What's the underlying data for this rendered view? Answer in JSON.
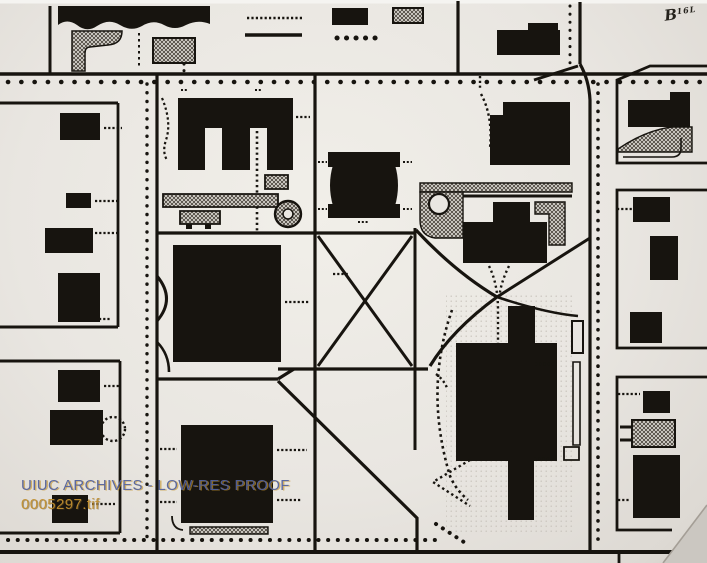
{
  "photo": {
    "description": "Archival black-and-white photograph of a campus block map",
    "colors": {
      "ink": "#17140f",
      "paper": "#e9e6e1",
      "paper_edge": "#f5f4f1",
      "hatch_line": "#4a443c",
      "fold": "#cbc7c1",
      "fold_edge": "#a49e96",
      "watermark_blue": "#55639b",
      "watermark_gold": "#c08e2e"
    }
  },
  "watermark": {
    "line1": "UIUC ARCHIVES - LOW-RES PROOF",
    "line2": "0005297.tif"
  },
  "annotation": {
    "prefix": "B",
    "suffix": "16L"
  },
  "map": {
    "shapes": [
      {
        "n": "photo-top-edge",
        "k": "f",
        "d": "M0,0H707V3.5H0Z",
        "f": "#f5f4f1"
      },
      {
        "n": "plaza-stipple",
        "k": "hl",
        "d": "M446,292h126v240h-126z"
      },
      {
        "n": "bldg-banner-nw",
        "k": "f",
        "d": "M58,6H210V24Q198,19 186,25Q175,31 164,25Q153,19 142,26Q131,32 120,25Q109,18 97,26Q87,33 77,25Q67,18 58,25Z"
      },
      {
        "n": "road-v-nw",
        "k": "s",
        "d": "M50,6V73",
        "w": 3
      },
      {
        "n": "hatch-lot-nw",
        "k": "h",
        "d": "M72,31H122Q122,44 108,45L90,47Q85,47 85,53V71H72Z",
        "w": 1.5
      },
      {
        "n": "dash-path-nw",
        "k": "s",
        "d": "M139,33V69",
        "w": 2,
        "da": "2.5 3.5"
      },
      {
        "n": "hatch-lot-nw2",
        "k": "h",
        "d": "M153,38h42v25h-42z",
        "w": 2
      },
      {
        "n": "dots-nw2",
        "k": "s",
        "d": "M184,64V76",
        "w": 3,
        "da": "0.1 6.5",
        "cap": "round"
      },
      {
        "n": "tick-row-top",
        "k": "s",
        "d": "M247,18H302",
        "w": 2.6,
        "da": "2.2 2.2"
      },
      {
        "n": "bar-line-top",
        "k": "s",
        "d": "M245,35H302",
        "w": 3.6
      },
      {
        "n": "bldg-top-1",
        "k": "f",
        "d": "M332,8h36v17h-36z"
      },
      {
        "n": "hatch-top-1",
        "k": "h",
        "d": "M393,8h30v15h-30z",
        "w": 2
      },
      {
        "n": "dot-row-top",
        "k": "s",
        "d": "M337,38H384",
        "w": 5,
        "da": "0.1 9.4",
        "cap": "round"
      },
      {
        "n": "bldg-top-2",
        "k": "f",
        "d": "M497,30h63v25h-63z"
      },
      {
        "n": "bldg-top-2b",
        "k": "f",
        "d": "M528,23h30v8h-30z"
      },
      {
        "n": "dots-v-ne",
        "k": "s",
        "d": "M570,6V66",
        "w": 3,
        "da": "0.1 8",
        "cap": "round"
      },
      {
        "n": "road-v-ne",
        "k": "s",
        "d": "M580,2V64",
        "w": 3.2
      },
      {
        "n": "road-ramp-ne",
        "k": "s",
        "d": "M578,66L534,80",
        "w": 3
      },
      {
        "n": "road-h-north",
        "k": "s",
        "d": "M0,74H707",
        "w": 3.6
      },
      {
        "n": "tree-dots-north",
        "k": "s",
        "d": "M8,82H700",
        "w": 4.6,
        "da": "0.1 13.2",
        "cap": "round"
      },
      {
        "n": "road-v-4",
        "k": "s",
        "d": "M458,1V74",
        "w": 3.2
      },
      {
        "n": "road-v-main-west",
        "k": "s",
        "d": "M157,74V552",
        "w": 3.2
      },
      {
        "n": "road-v-center",
        "k": "s",
        "d": "M315,74V552",
        "w": 3.2
      },
      {
        "n": "road-v-east",
        "k": "s",
        "d": "M580,64Q589,80 590,100V552",
        "w": 3.2
      },
      {
        "n": "tree-dots-v-west",
        "k": "s",
        "d": "M147,84V543",
        "w": 3.4,
        "da": "0.1 8.6",
        "cap": "round"
      },
      {
        "n": "tree-dots-v-east",
        "k": "s",
        "d": "M598,84V548",
        "w": 3.6,
        "da": "0.1 9",
        "cap": "round"
      },
      {
        "n": "road-h-south",
        "k": "s",
        "d": "M0,552H707",
        "w": 4
      },
      {
        "n": "tree-dots-south",
        "k": "s",
        "d": "M8,540H437",
        "w": 4,
        "da": "0.1 9.6",
        "cap": "round"
      },
      {
        "n": "road-h-w1",
        "k": "s",
        "d": "M0,103H118",
        "w": 3
      },
      {
        "n": "block-edge-w1",
        "k": "s",
        "d": "M118,103V327",
        "w": 2.8
      },
      {
        "n": "road-h-w2",
        "k": "s",
        "d": "M0,327H118",
        "w": 3
      },
      {
        "n": "road-h-w3",
        "k": "s",
        "d": "M0,361H120",
        "w": 3
      },
      {
        "n": "block-edge-w2",
        "k": "s",
        "d": "M120,361V533",
        "w": 2.8
      },
      {
        "n": "road-h-w4",
        "k": "s",
        "d": "M0,533H120",
        "w": 3
      },
      {
        "n": "bldg-w1",
        "k": "f",
        "d": "M60,113h40v27h-40z"
      },
      {
        "n": "bldg-w2",
        "k": "f",
        "d": "M66,193h25v15h-25z"
      },
      {
        "n": "bldg-w3",
        "k": "f",
        "d": "M45,228h48v25h-48z"
      },
      {
        "n": "bldg-w4",
        "k": "f",
        "d": "M58,273h42v49h-42z"
      },
      {
        "n": "dash-w1",
        "k": "s",
        "d": "M104,128H122",
        "w": 2.2,
        "da": "2.2 2"
      },
      {
        "n": "dash-w2",
        "k": "s",
        "d": "M95,201H118",
        "w": 2.2,
        "da": "2.2 2"
      },
      {
        "n": "dash-w3",
        "k": "s",
        "d": "M95,233H117",
        "w": 2.2,
        "da": "2.2 2"
      },
      {
        "n": "dash-w4",
        "k": "s",
        "d": "M99,319H110",
        "w": 2.2,
        "da": "2.2 2"
      },
      {
        "n": "bldg-w5",
        "k": "f",
        "d": "M58,370h42v32h-42z"
      },
      {
        "n": "bldg-w6",
        "k": "f",
        "d": "M50,410h53v35h-53z"
      },
      {
        "n": "bldg-w7",
        "k": "f",
        "d": "M52,495h36v28h-36z"
      },
      {
        "n": "dash-w5",
        "k": "s",
        "d": "M104,386H120",
        "w": 2.2,
        "da": "2.2 2"
      },
      {
        "n": "dash-w6",
        "k": "s",
        "d": "M92,504H115",
        "w": 2.2,
        "da": "2.2 2"
      },
      {
        "n": "dashed-circle-w",
        "k": "c",
        "cx": 113,
        "cy": 429,
        "r": 12,
        "w": 2.4,
        "da": "2.3 2.5"
      },
      {
        "n": "bldg-comb-e",
        "k": "f",
        "d": "M178,98H293V170H267V128H250V170H222V128H205V170H178Z"
      },
      {
        "n": "dash-e-top1",
        "k": "s",
        "d": "M181,90H187",
        "w": 2,
        "da": "2 1.8"
      },
      {
        "n": "dash-e-top2",
        "k": "s",
        "d": "M255,90H261",
        "w": 2,
        "da": "2 1.8"
      },
      {
        "n": "dash-e-left-curve",
        "k": "s",
        "d": "M162,98Q172,122 166,140Q162,152 167,160",
        "w": 2.2,
        "da": "2.4 2.6"
      },
      {
        "n": "dash-e-right",
        "k": "s",
        "d": "M296,117H310",
        "w": 2.2,
        "da": "2.2 2"
      },
      {
        "n": "dotted-path-e",
        "k": "s",
        "d": "M257,131V231",
        "w": 2.6,
        "da": "2.2 3.2"
      },
      {
        "n": "loop-band-hatch",
        "k": "h",
        "d": "M163,194h115v13h-115z",
        "w": 1.8
      },
      {
        "n": "loop-circle",
        "k": "c",
        "cx": 288,
        "cy": 214,
        "r": 13,
        "f": "url(#hp)",
        "w": 2.4
      },
      {
        "n": "loop-circle-center",
        "k": "c",
        "cx": 288,
        "cy": 214,
        "r": 5,
        "f": "#e9e6e1",
        "w": 1.6
      },
      {
        "n": "hatch-pad-e",
        "k": "h",
        "d": "M180,211h40v13h-40z",
        "w": 1.8
      },
      {
        "n": "pad-leg1",
        "k": "f",
        "d": "M186,224h6v5h-6z"
      },
      {
        "n": "pad-leg2",
        "k": "f",
        "d": "M205,224h6v5h-6z"
      },
      {
        "n": "hatch-pad-e2",
        "k": "h",
        "d": "M265,175h23v14h-23z",
        "w": 1.8
      },
      {
        "n": "road-h-quad-n",
        "k": "s",
        "d": "M157,233H416",
        "w": 3.2
      },
      {
        "n": "bldg-big-nw",
        "k": "f",
        "d": "M173,245h108v117h-108z"
      },
      {
        "n": "drive-arc",
        "k": "s",
        "d": "M157,276Q176,299 157,321",
        "w": 3
      },
      {
        "n": "dash-c1",
        "k": "s",
        "d": "M285,302H310",
        "w": 2.2,
        "da": "2.2 2"
      },
      {
        "n": "road-h-mid-w",
        "k": "s",
        "d": "M157,379H278",
        "w": 3.2
      },
      {
        "n": "drive-arc2",
        "k": "s",
        "d": "M157,342Q169,354 169,372",
        "w": 2.6
      },
      {
        "n": "road-y-join",
        "k": "s",
        "d": "M278,379L294,369",
        "w": 3.2
      },
      {
        "n": "road-h-mid",
        "k": "s",
        "d": "M278,369H428",
        "w": 3.2
      },
      {
        "n": "bldg-barrel-top",
        "k": "f",
        "d": "M328,152h72v15h-72z"
      },
      {
        "n": "bldg-barrel-bot",
        "k": "f",
        "d": "M328,204h72v14h-72z"
      },
      {
        "n": "bldg-barrel-mid",
        "k": "f",
        "d": "M333,165Q327,185 333,206L395,206Q401,185 395,165Z"
      },
      {
        "n": "dash-b1",
        "k": "s",
        "d": "M318,162H327",
        "w": 2,
        "da": "2 1.8"
      },
      {
        "n": "dash-b2",
        "k": "s",
        "d": "M403,162H412",
        "w": 2,
        "da": "2 1.8"
      },
      {
        "n": "dash-b3",
        "k": "s",
        "d": "M318,209H327",
        "w": 2,
        "da": "2 1.8"
      },
      {
        "n": "dash-b4",
        "k": "s",
        "d": "M403,209H412",
        "w": 2,
        "da": "2 1.8"
      },
      {
        "n": "dash-b5",
        "k": "s",
        "d": "M358,222H368",
        "w": 2,
        "da": "2 1.8"
      },
      {
        "n": "dash-b6",
        "k": "s",
        "d": "M333,274H348",
        "w": 2.2,
        "da": "2.2 2"
      },
      {
        "n": "road-diag-x1",
        "k": "s",
        "d": "M318,236L412,366",
        "w": 3
      },
      {
        "n": "road-diag-x2",
        "k": "s",
        "d": "M412,236L318,366",
        "w": 3
      },
      {
        "n": "road-v-quad-e",
        "k": "s",
        "d": "M415,228V450",
        "w": 3
      },
      {
        "n": "road-curve-ne",
        "k": "s",
        "d": "M416,230Q455,272 497,297",
        "w": 3.2
      },
      {
        "n": "road-curve-sw",
        "k": "s",
        "d": "M497,297Q452,330 430,366",
        "w": 3.2
      },
      {
        "n": "road-diag-e",
        "k": "s",
        "d": "M590,238L497,297",
        "w": 3
      },
      {
        "n": "road-spur-e",
        "k": "s",
        "d": "M497,297Q545,313 578,316",
        "w": 2.6
      },
      {
        "n": "road-diag-s",
        "k": "s",
        "d": "M278,381L417,518V552",
        "w": 3.2
      },
      {
        "n": "tree-band-hatch",
        "k": "h",
        "d": "M420,183h152v9h-152z",
        "w": 1.4
      },
      {
        "n": "road-h-plaza",
        "k": "s",
        "d": "M457,196H572",
        "w": 3
      },
      {
        "n": "plaza-hatch",
        "k": "h",
        "d": "M420,192h43v46h-28Q420,236 420,220Z",
        "w": 1.4
      },
      {
        "n": "pond",
        "k": "c",
        "cx": 439,
        "cy": 204,
        "r": 10,
        "f": "#e9e6e1",
        "w": 2.2
      },
      {
        "n": "bldg-n-annex",
        "k": "f",
        "d": "M493,202h37v20h-37z"
      },
      {
        "n": "bldg-n-main",
        "k": "f",
        "d": "M463,222h84v41h-84z"
      },
      {
        "n": "hatch-court-e",
        "k": "h",
        "d": "M535,202h30v43h-16v-31h-14z",
        "w": 1.4
      },
      {
        "n": "dash-path-ne1",
        "k": "s",
        "d": "M480,76V90",
        "w": 2.4,
        "da": "2.2 2.6"
      },
      {
        "n": "dash-path-ne2",
        "k": "s",
        "d": "M481,94Q493,116 490,148",
        "w": 2.4,
        "da": "2.4 2.8"
      },
      {
        "n": "bldg-ne-block",
        "k": "f",
        "d": "M503,102H570V165H490V115H503Z"
      },
      {
        "n": "dotted-pair-1",
        "k": "s",
        "d": "M489,266Q498,284 498,310V346",
        "w": 2.4,
        "da": "2.2 3"
      },
      {
        "n": "dotted-pair-2",
        "k": "s",
        "d": "M509,266Q500,284 499,300",
        "w": 2.4,
        "da": "2.2 3"
      },
      {
        "n": "bldg-cross-n",
        "k": "f",
        "d": "M508,306h27v37h-27z"
      },
      {
        "n": "bldg-cross-main",
        "k": "f",
        "d": "M456,343h101v118h-101z"
      },
      {
        "n": "bldg-cross-s",
        "k": "f",
        "d": "M508,461h26v59h-26z"
      },
      {
        "n": "walk-outline-e1",
        "k": "s",
        "d": "M572,321h11v32h-11z",
        "w": 2
      },
      {
        "n": "walk-outline-e2",
        "k": "s",
        "d": "M573,362h7v83h-7z",
        "w": 1.6
      },
      {
        "n": "walk-outline-e3",
        "k": "s",
        "d": "M564,447h15v13h-15z",
        "w": 1.8
      },
      {
        "n": "dash-cr1",
        "k": "s",
        "d": "M535,364H557",
        "w": 2.2,
        "da": "2.2 2"
      },
      {
        "n": "dash-cr2",
        "k": "s",
        "d": "M534,459H550",
        "w": 2.2,
        "da": "2.2 2"
      },
      {
        "n": "dotted-arc-w",
        "k": "s",
        "d": "M452,310Q424,390 450,476Q456,490 468,500",
        "w": 2.6,
        "da": "2.6 3.4"
      },
      {
        "n": "dotted-v-tail",
        "k": "s",
        "d": "M436,374Q444,380 447,388",
        "w": 2.4,
        "da": "2.2 2.8"
      },
      {
        "n": "dotted-chevron",
        "k": "s",
        "d": "M470,460L433,482L470,506",
        "w": 2.4,
        "da": "2.4 3"
      },
      {
        "n": "dotted-diag-se",
        "k": "s",
        "d": "M436,524L470,546",
        "w": 4,
        "da": "0.1 8",
        "cap": "round"
      },
      {
        "n": "bldg-big-s",
        "k": "f",
        "d": "M181,425h92v98h-92z"
      },
      {
        "n": "steps-hatch-s",
        "k": "h",
        "d": "M190,527h78v7h-78z",
        "w": 1.4
      },
      {
        "n": "walk-curve-s",
        "k": "s",
        "d": "M172,516Q172,529 183,530",
        "w": 1.8
      },
      {
        "n": "dash-s1",
        "k": "s",
        "d": "M160,449H177",
        "w": 2.2,
        "da": "2.2 2"
      },
      {
        "n": "dash-s2",
        "k": "s",
        "d": "M277,450H307",
        "w": 2.2,
        "da": "2.2 2"
      },
      {
        "n": "dash-s3",
        "k": "s",
        "d": "M160,502H177",
        "w": 2.2,
        "da": "2.2 2"
      },
      {
        "n": "dash-s4",
        "k": "s",
        "d": "M277,500H302",
        "w": 2.2,
        "da": "2.2 2"
      },
      {
        "n": "block-ne-outline",
        "k": "s",
        "d": "M707,66H650L617,80V163H707",
        "w": 2.8
      },
      {
        "n": "bldg-ne1",
        "k": "f",
        "d": "M628,100h62v27h-62z"
      },
      {
        "n": "bldg-ne1b",
        "k": "f",
        "d": "M670,92h20v8h-20z"
      },
      {
        "n": "hatch-slope-ne",
        "k": "h",
        "d": "M618,149Q646,130 672,127H692V152H618Z",
        "w": 1.4
      },
      {
        "n": "walk-ne",
        "k": "s",
        "d": "M623,157H672Q681,157 681,148V138",
        "w": 1.6
      },
      {
        "n": "block-e2-outline",
        "k": "s",
        "d": "M707,190H617V348H707",
        "w": 2.8
      },
      {
        "n": "bldg-e21",
        "k": "f",
        "d": "M633,197h37v25h-37z"
      },
      {
        "n": "bldg-e22",
        "k": "f",
        "d": "M650,236h28v44h-28z"
      },
      {
        "n": "bldg-e23",
        "k": "f",
        "d": "M630,312h32v31h-32z"
      },
      {
        "n": "dash-e21",
        "k": "s",
        "d": "M617,209H633",
        "w": 2.2,
        "da": "2.2 2"
      },
      {
        "n": "block-e3-outline",
        "k": "s",
        "d": "M707,377H617V530H672",
        "w": 2.8
      },
      {
        "n": "bldg-e31",
        "k": "f",
        "d": "M643,391h27v22h-27z"
      },
      {
        "n": "dash-e31",
        "k": "s",
        "d": "M618,394H640",
        "w": 2.2,
        "da": "2.2 2"
      },
      {
        "n": "hatch-pad-e3",
        "k": "h",
        "d": "M632,420h43v27h-43z",
        "w": 2
      },
      {
        "n": "tab-e31",
        "k": "s",
        "d": "M620,427H632",
        "w": 3
      },
      {
        "n": "tab-e32",
        "k": "s",
        "d": "M620,440H632",
        "w": 3
      },
      {
        "n": "bldg-e32",
        "k": "f",
        "d": "M633,455h47v63h-47z"
      },
      {
        "n": "dash-e33",
        "k": "s",
        "d": "M618,500H630",
        "w": 2.2,
        "da": "2.2 2"
      },
      {
        "n": "block-e4-outline",
        "k": "s",
        "d": "M619,563V552H700",
        "w": 2.8
      },
      {
        "n": "corner-fold",
        "k": "f",
        "d": "M663,563L707,505V563Z",
        "f": "#cbc7c1"
      },
      {
        "n": "corner-fold-edge",
        "k": "s",
        "d": "M663,563L707,505",
        "w": 1.6,
        "col": "#a49e96"
      }
    ]
  }
}
